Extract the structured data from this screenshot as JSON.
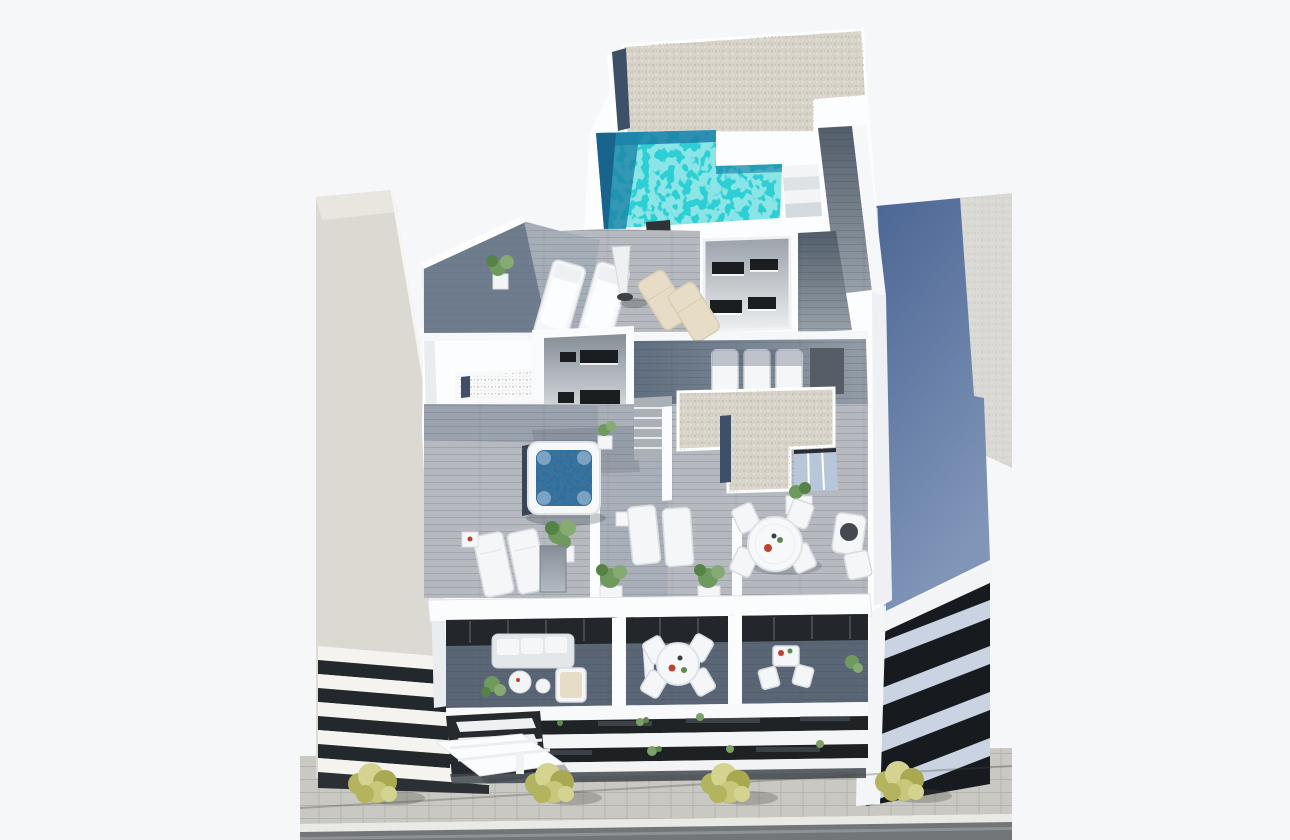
{
  "meta": {
    "type": "architectural-3d-render",
    "description": "Aerial 3D visualization of a residential building rooftop with an L-shaped swimming pool, wood-deck terraces, hot tub, outdoor furniture, neighbouring buildings and a street with trees"
  },
  "palette": {
    "bg": "#f6f7f9",
    "wall": "#fcfdfe",
    "wall_shade": "#e9ecef",
    "gravel": "#d7d3c9",
    "pool": "#2ccfd3",
    "pool_shadow": "#1b7fa6",
    "pool_deep": "#19648c",
    "deck_light": "#b6bac0",
    "deck_mid": "#99a1aa",
    "deck_shade": "#5e6d80",
    "window": "#1b1e21",
    "skylight": "#3d5068",
    "hottub": "#2f6f9f",
    "left_bldg": "#dcd9d2",
    "blue_wall": "#54709f",
    "sidewalk": "#c9c8c2",
    "road": "#737678",
    "curb": "#e9e9e5",
    "tree": "#c9c77b",
    "plant": "#6f9a5d",
    "cushion": "#e7ddc7",
    "glass": "#b7c6d8"
  },
  "scene": {
    "main_building": {
      "label": "main building rooftop",
      "elements": [
        "gravel roof",
        "roof skylight strip",
        "L-shaped swimming pool",
        "pool steps",
        "wood walkway",
        "two white sun loungers",
        "closed parasol",
        "two beige deck chairs",
        "outdoor chimney",
        "lightwell courtyard with windows",
        "stair bulkhead with windows",
        "planter boxes with skylights",
        "square hot tub",
        "outdoor shower",
        "pairs of loungers with side tables",
        "potted plants",
        "round dining table with four chairs",
        "lounge seat set",
        "terrace divider walls",
        "balcony sofa with coffee tables",
        "balcony round dining set",
        "folded balcony parasol",
        "louvered facade fins",
        "slab facade bands",
        "entrance canopy"
      ]
    },
    "left_building": {
      "label": "neighbouring building left",
      "elements": [
        "plain light facade",
        "balcony slab bands"
      ]
    },
    "right_building": {
      "label": "neighbouring building right",
      "elements": [
        "blue side wall",
        "gravel roof",
        "balcony slab bands"
      ]
    },
    "street": {
      "label": "street",
      "elements": [
        "paved sidewalk",
        "four street trees",
        "cable shadow",
        "curb",
        "road"
      ]
    }
  }
}
